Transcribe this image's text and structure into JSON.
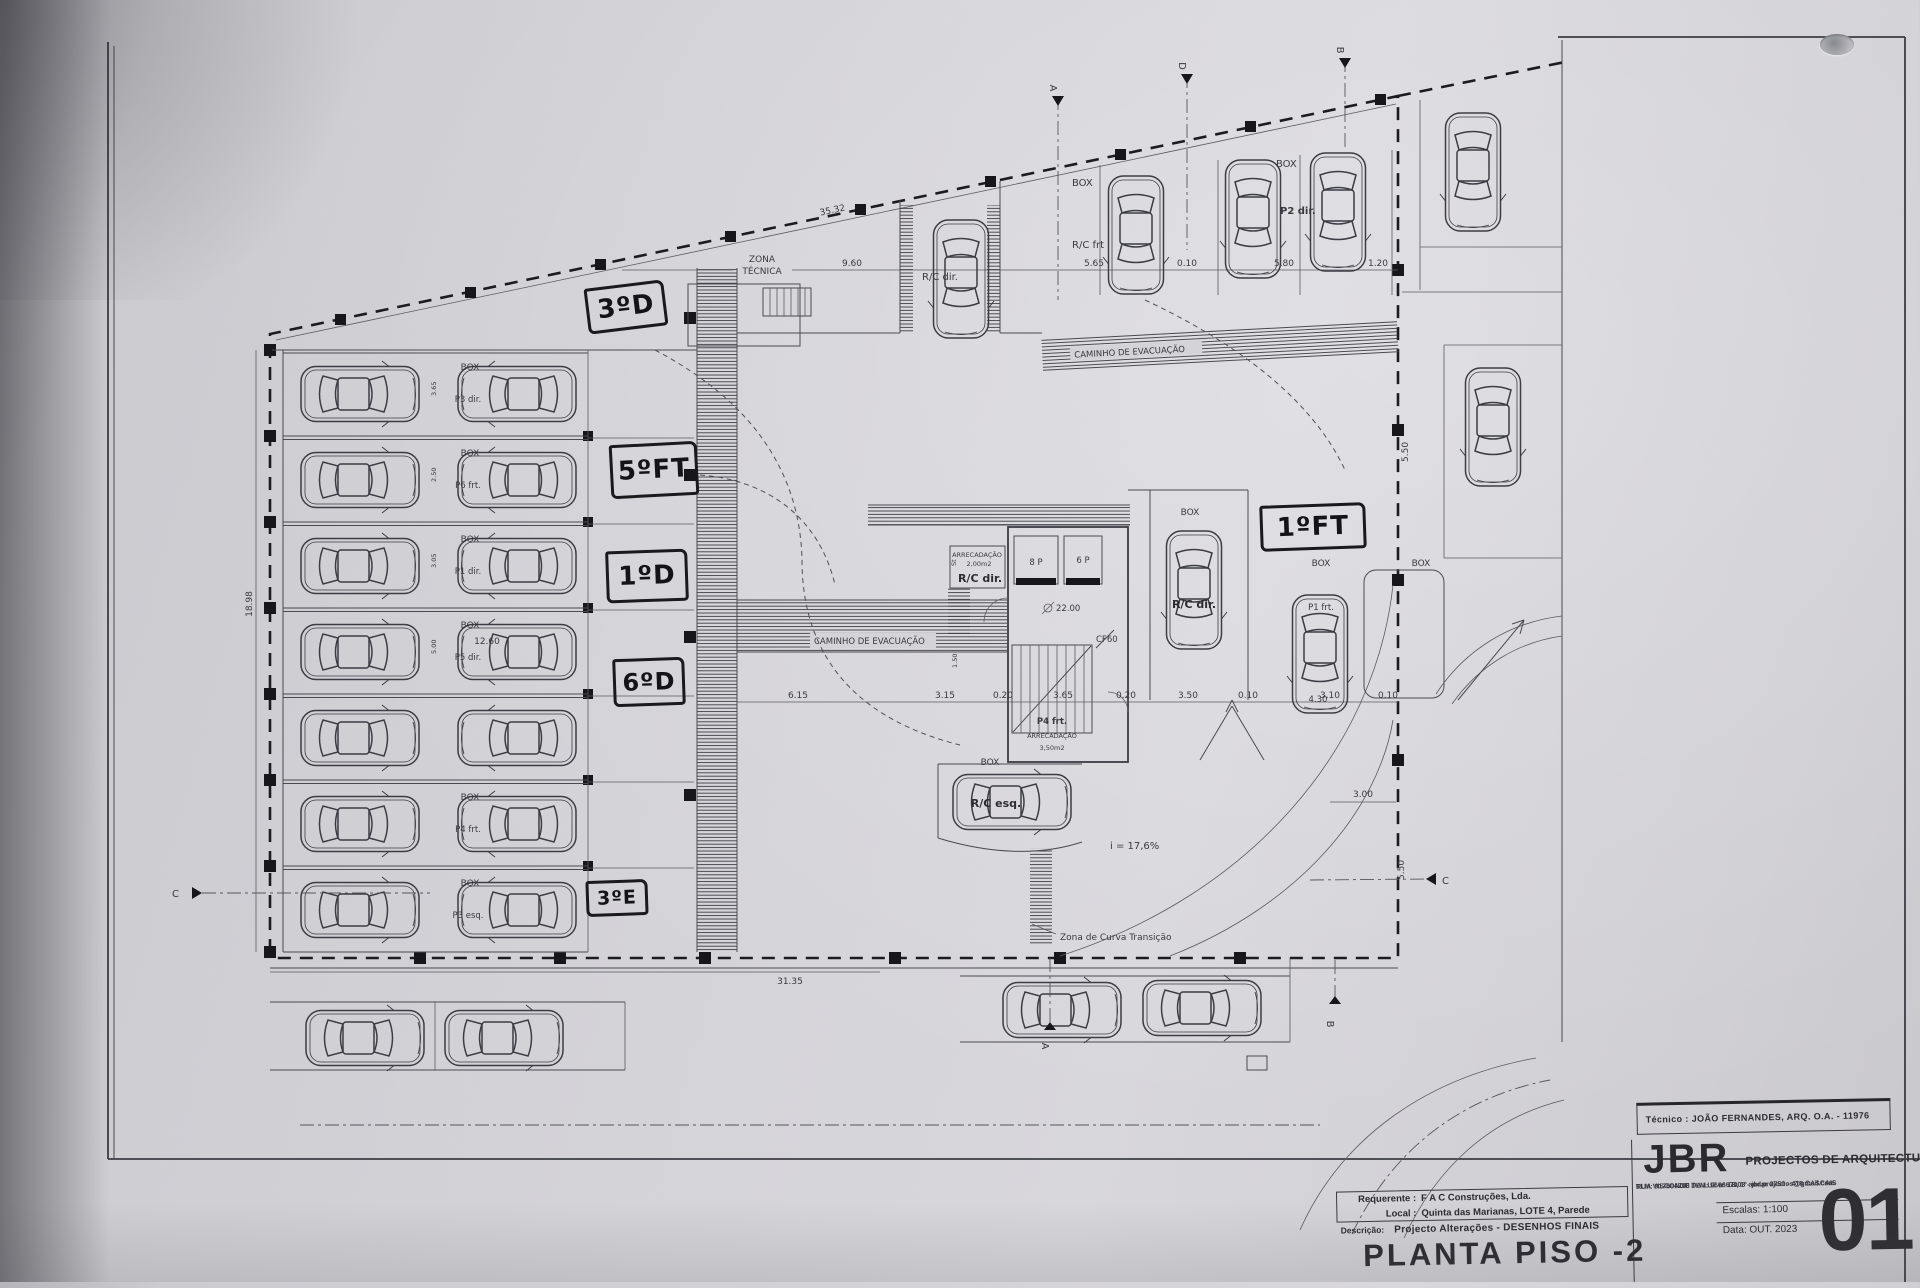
{
  "hand_annotations": [
    {
      "label": "3ºD"
    },
    {
      "label": "5ºFT"
    },
    {
      "label": "1ºD"
    },
    {
      "label": "6ºD"
    },
    {
      "label": "3ºE"
    },
    {
      "label": "1ºFT"
    }
  ],
  "plan": {
    "labels": {
      "box": "BOX",
      "zona1": "ZONA",
      "zona2": "TÉCNICA",
      "caminho": "CAMINHO DE EVACUAÇÃO",
      "rc_frt": "R/C frt",
      "rc_dir": "R/C dir.",
      "rc_esq": "R/C esq.",
      "p2_dir": "P2 dir.",
      "p1_frt": "P1 frt.",
      "p4_frt": "P4 frt.",
      "arrecadacao": "ARRECADAÇÃO",
      "area_small": "2,00m2",
      "area_big": "3,50m2",
      "st": "St",
      "lift8": "8 P",
      "lift6": "6 P",
      "cf60": "CF60",
      "level": "22.00",
      "slope": "i = 17,6%",
      "curve_zone": "Zona de Curva Transição"
    },
    "sections": {
      "a": "A",
      "b": "B",
      "c": "C",
      "d": "D"
    },
    "dims": {
      "top_slant": "35.32",
      "d960": "9.60",
      "d565": "5.65",
      "d010a": "0.10",
      "d580": "5.80",
      "d120": "1.20",
      "d615": "6.15",
      "d315": "3.15",
      "d020a": "0.20",
      "d365": "3.65",
      "d020b": "0.20",
      "d350": "3.50",
      "d010b": "0.10",
      "d310": "3.10",
      "d010c": "0.10",
      "d1260": "12.60",
      "d1898": "18.98",
      "d3135": "31.35",
      "d300": "3.00",
      "d550": "5.50",
      "d430": "4.30",
      "d150": "1.50",
      "row365": "3.65",
      "row250": "2.50",
      "row305": "3.05",
      "row500": "5.00"
    },
    "left_rows": [
      {
        "box": "BOX",
        "stall": "P3 dir."
      },
      {
        "box": "BOX",
        "stall": "P6 frt."
      },
      {
        "box": "BOX",
        "stall": "P1 dir."
      },
      {
        "box": "BOX",
        "stall": "P5 dir."
      },
      {
        "box": "",
        "stall": ""
      },
      {
        "box": "BOX",
        "stall": "P4 frt."
      },
      {
        "box": "BOX",
        "stall": "P3 esq."
      }
    ]
  },
  "title_block": {
    "tecnico": "Técnico : JOÃO FERNANDES, ARQ.   O.A. - 11976",
    "firm": "JBR",
    "firm_sub": "PROJECTOS DE ARQUITECTURA",
    "firm_address": "RUA VISCONDE DA LUZ nº 1B, 1º andar  2750 - 418  CASCAIS",
    "firm_contacts": "TLM: 917604208  TLM: 966667008 - jbr.projectos@gmail.com",
    "requerente_label": "Requerente :",
    "requerente": "F A C  Construções, Lda.",
    "local_label": "Local :",
    "local": "Quinta das Marianas, LOTE 4, Parede",
    "descricao_label": "Descrição:",
    "descricao": "Projecto Alterações - DESENHOS FINAIS",
    "drawing_title": "PLANTA PISO -2",
    "escala_label": "Escalas:  1:100",
    "data_label": "Data:  OUT.  2023",
    "sheet_number": "01"
  }
}
